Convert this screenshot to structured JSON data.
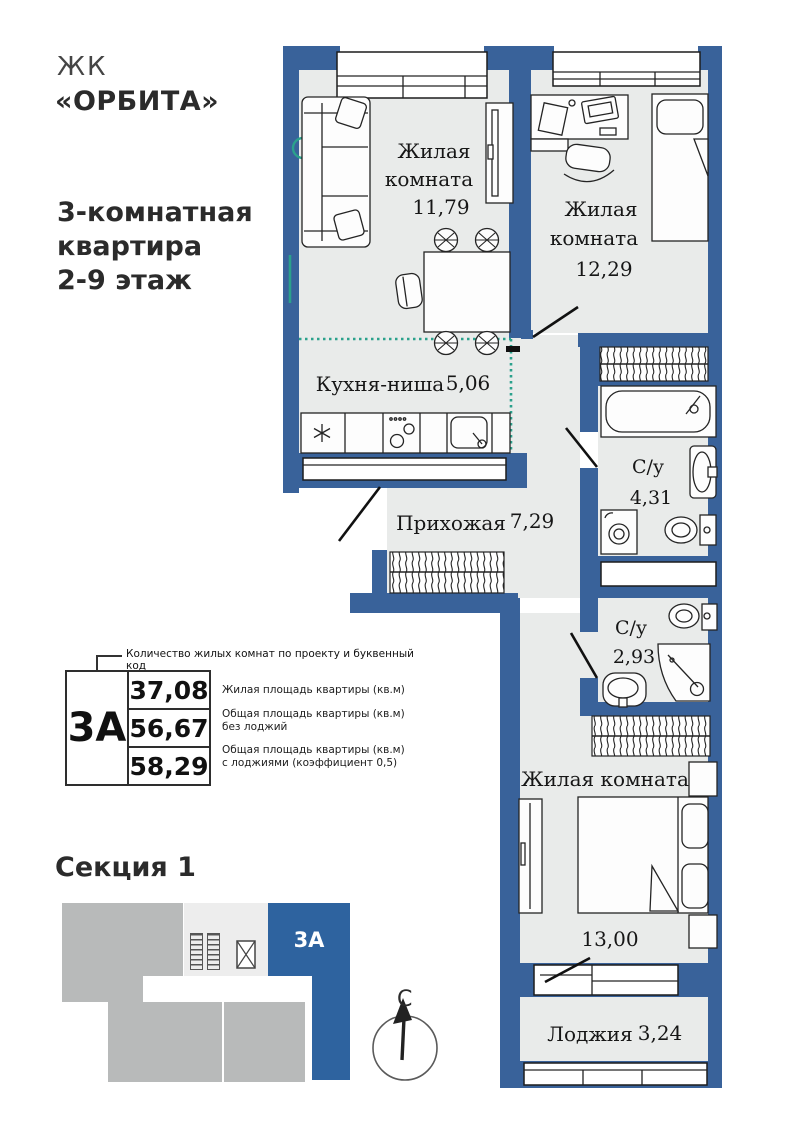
{
  "branding": {
    "prefix": "ЖК",
    "name": "«ОРБИТА»"
  },
  "apartment": {
    "title_lines": [
      "3-комнатная",
      "квартира",
      "2-9 этаж"
    ]
  },
  "plan": {
    "rooms": [
      {
        "lines": [
          "Жилая",
          "комната"
        ],
        "area": "11,79"
      },
      {
        "lines": [
          "Жилая",
          "комната"
        ],
        "area": "12,29"
      },
      {
        "name": "Кухня-ниша",
        "area": "5,06"
      },
      {
        "name": "Прихожая",
        "area": "7,29"
      },
      {
        "name": "С/у",
        "area": "4,31"
      },
      {
        "name": "С/у",
        "area": "2,93"
      },
      {
        "name": "Жилая комната",
        "area": "13,00"
      },
      {
        "name": "Лоджия",
        "area": "3,24"
      }
    ]
  },
  "legend": {
    "callout": "Количество жилых комнат по проекту и буквенный код",
    "code": "3А",
    "rows": [
      {
        "value": "37,08",
        "label": "Жилая площадь квартиры (кв.м)"
      },
      {
        "value": "56,67",
        "label": "Общая площадь квартиры (кв.м)\nбез лоджий"
      },
      {
        "value": "58,29",
        "label": "Общая площадь квартиры (кв.м)\nс лоджиями (коэффициент 0,5)"
      }
    ]
  },
  "section": {
    "title": "Секция 1",
    "unit": "3А"
  },
  "compass": {
    "north": "С"
  },
  "colors": {
    "wall": "#39629a",
    "section_blue": "#2e639f",
    "room_fill": "#e9ebea",
    "kitchen_line": "#2ba18c",
    "block_gray": "#b8baba",
    "core_gray": "#ededed"
  }
}
